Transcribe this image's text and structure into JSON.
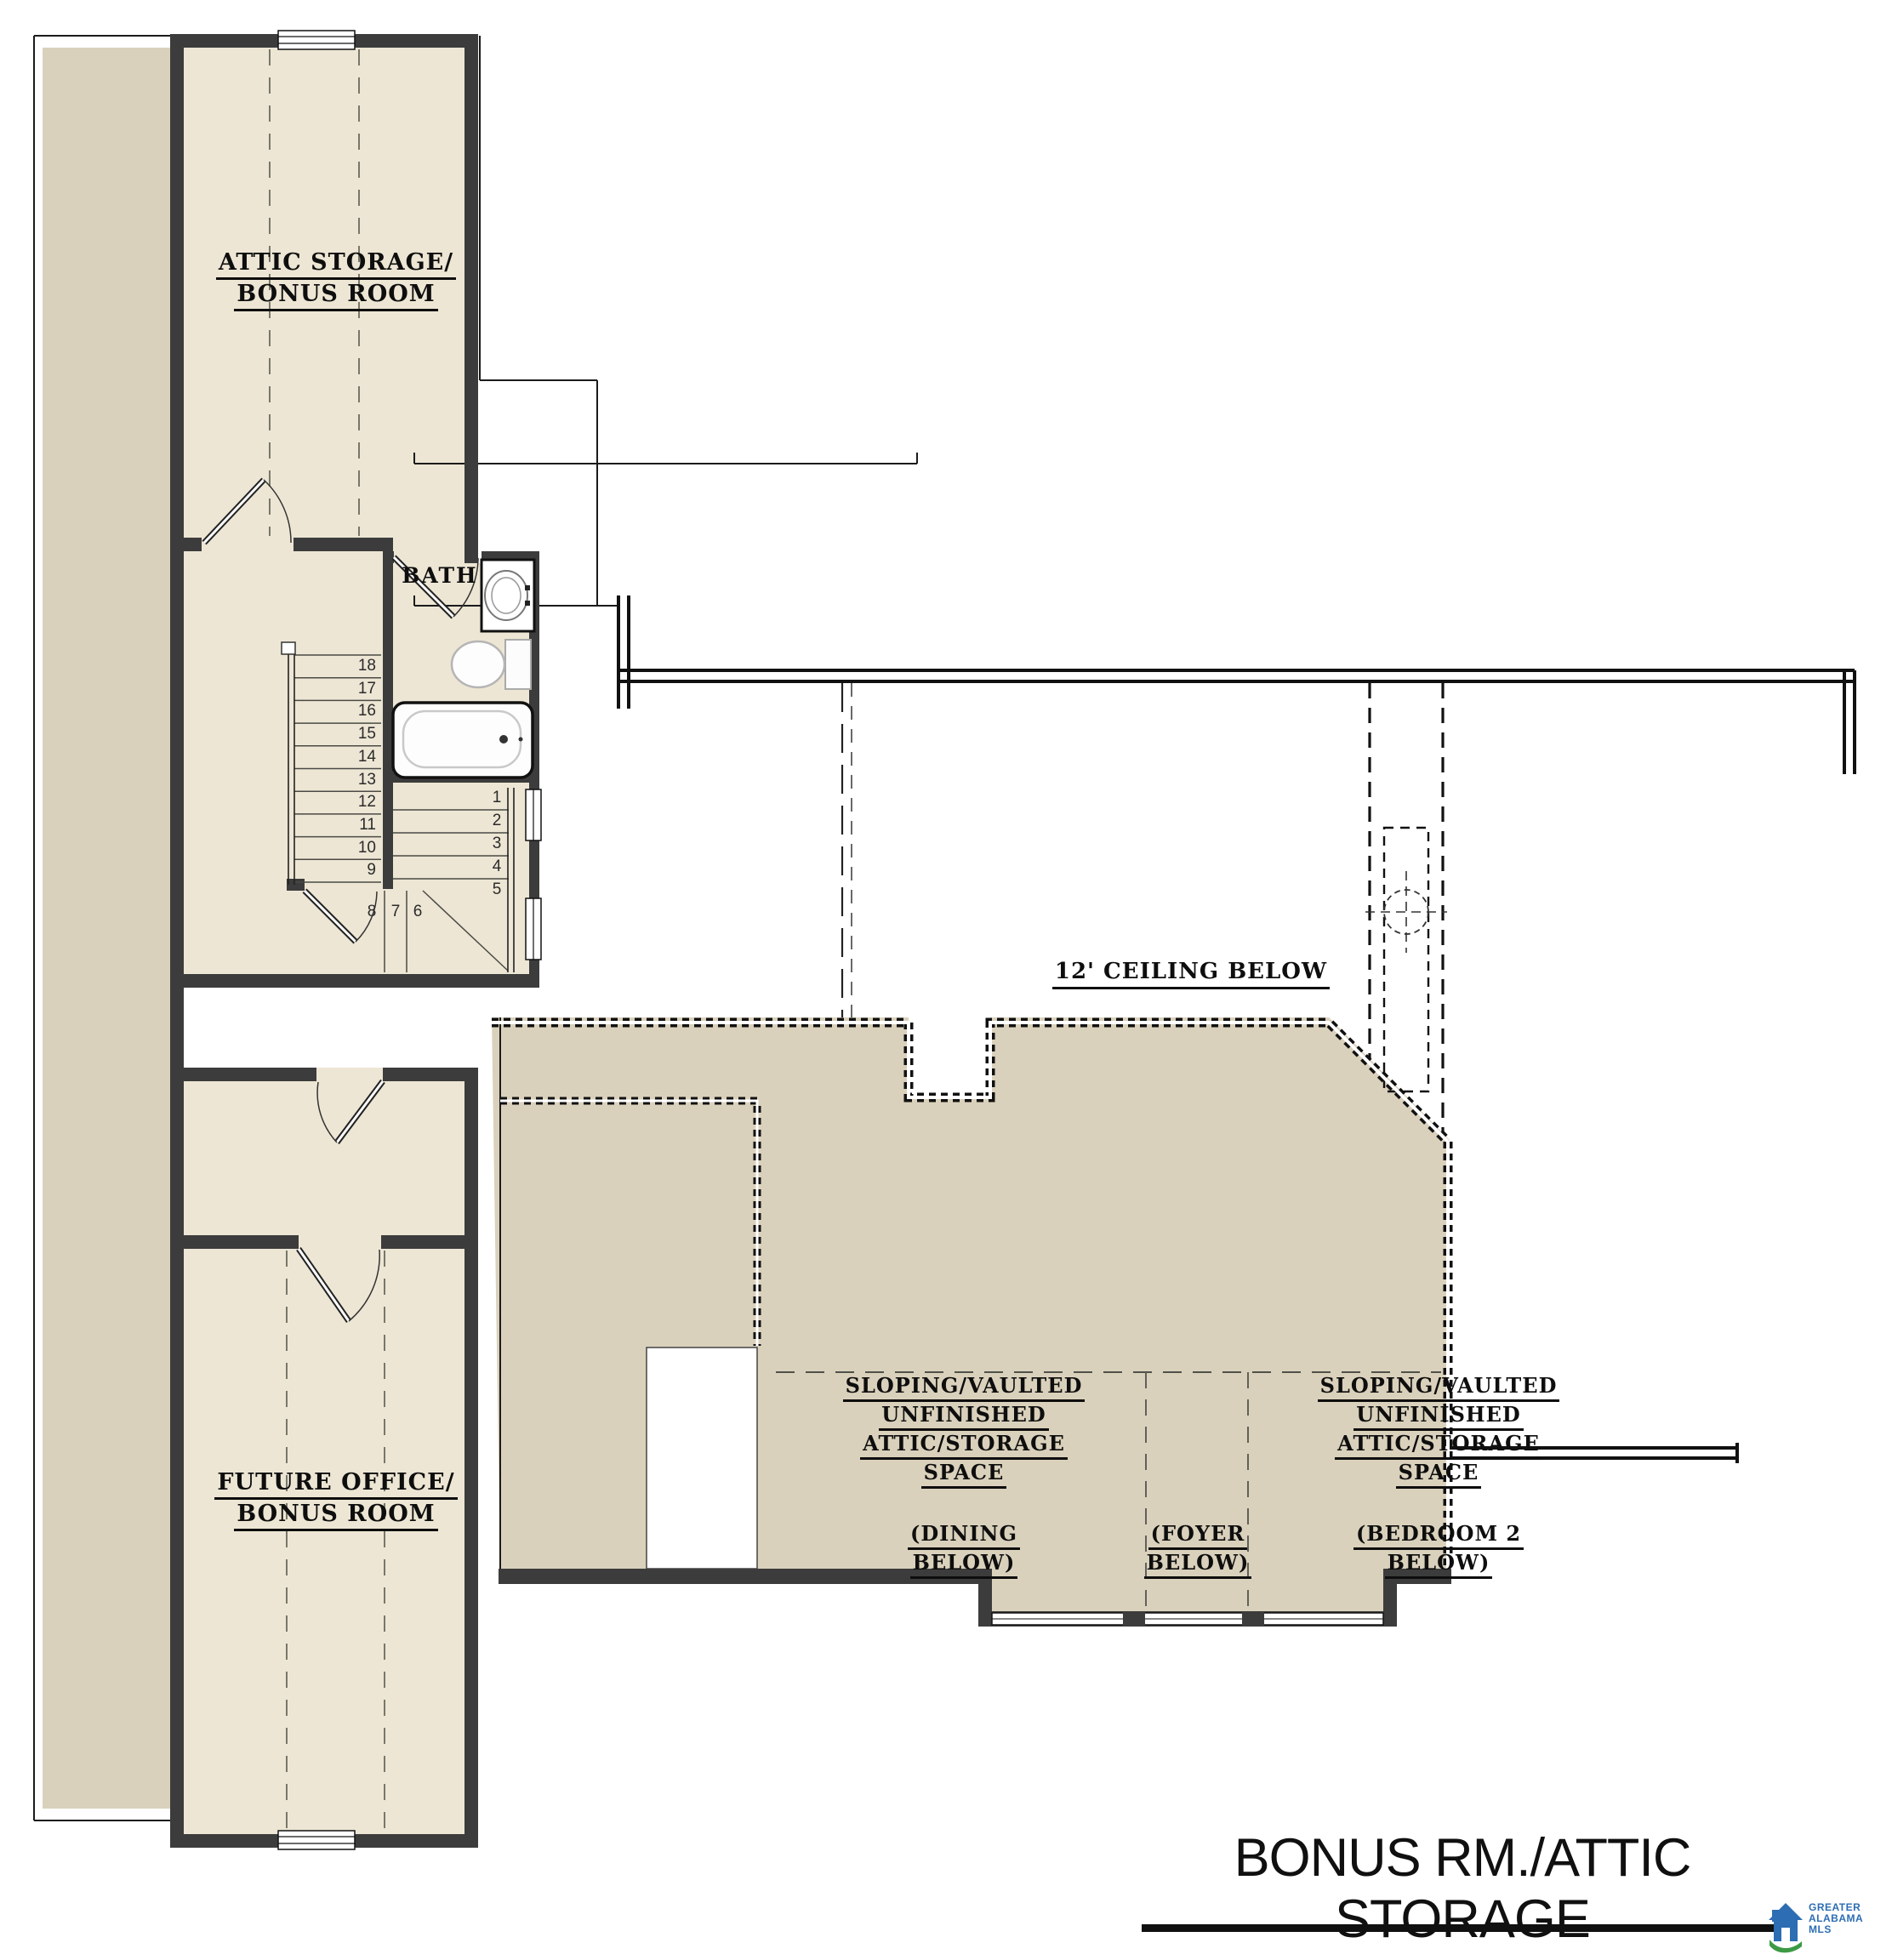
{
  "colors": {
    "cream": "#EDE6D4",
    "beige": "#DAD1BC",
    "wall": "#3C3C3C",
    "line": "#1B1B1B",
    "logo_blue": "#2C6DB3",
    "logo_green": "#3C9A44"
  },
  "rooms": {
    "attic_storage": {
      "line1": "ATTIC STORAGE/",
      "line2": "BONUS ROOM"
    },
    "bath": {
      "label": "BATH"
    },
    "ceiling": {
      "label": "12' CEILING BELOW"
    },
    "future_office": {
      "line1": "FUTURE OFFICE/",
      "line2": "BONUS ROOM"
    },
    "attic_dining": {
      "line1": "SLOPING/VAULTED",
      "line2": "UNFINISHED",
      "line3": "ATTIC/STORAGE",
      "line4": "SPACE",
      "sub1": "(DINING",
      "sub2": "BELOW)"
    },
    "attic_bedroom": {
      "line1": "SLOPING/VAULTED",
      "line2": "UNFINISHED",
      "line3": "ATTIC/STORAGE",
      "line4": "SPACE",
      "sub1": "(BEDROOM 2",
      "sub2": "BELOW)"
    },
    "foyer": {
      "sub1": "(FOYER",
      "sub2": "BELOW)"
    }
  },
  "stairs": {
    "upper_flight": [
      "18",
      "17",
      "16",
      "15",
      "14",
      "13",
      "12",
      "11",
      "10",
      "9"
    ],
    "lower_flight": [
      "1",
      "2",
      "3",
      "4",
      "5"
    ],
    "winders": [
      "8",
      "7",
      "6"
    ]
  },
  "footer": {
    "title": "BONUS RM./ATTIC STORAGE"
  },
  "logo": {
    "line1": "GREATER",
    "line2": "ALABAMA",
    "line3": "MLS"
  }
}
